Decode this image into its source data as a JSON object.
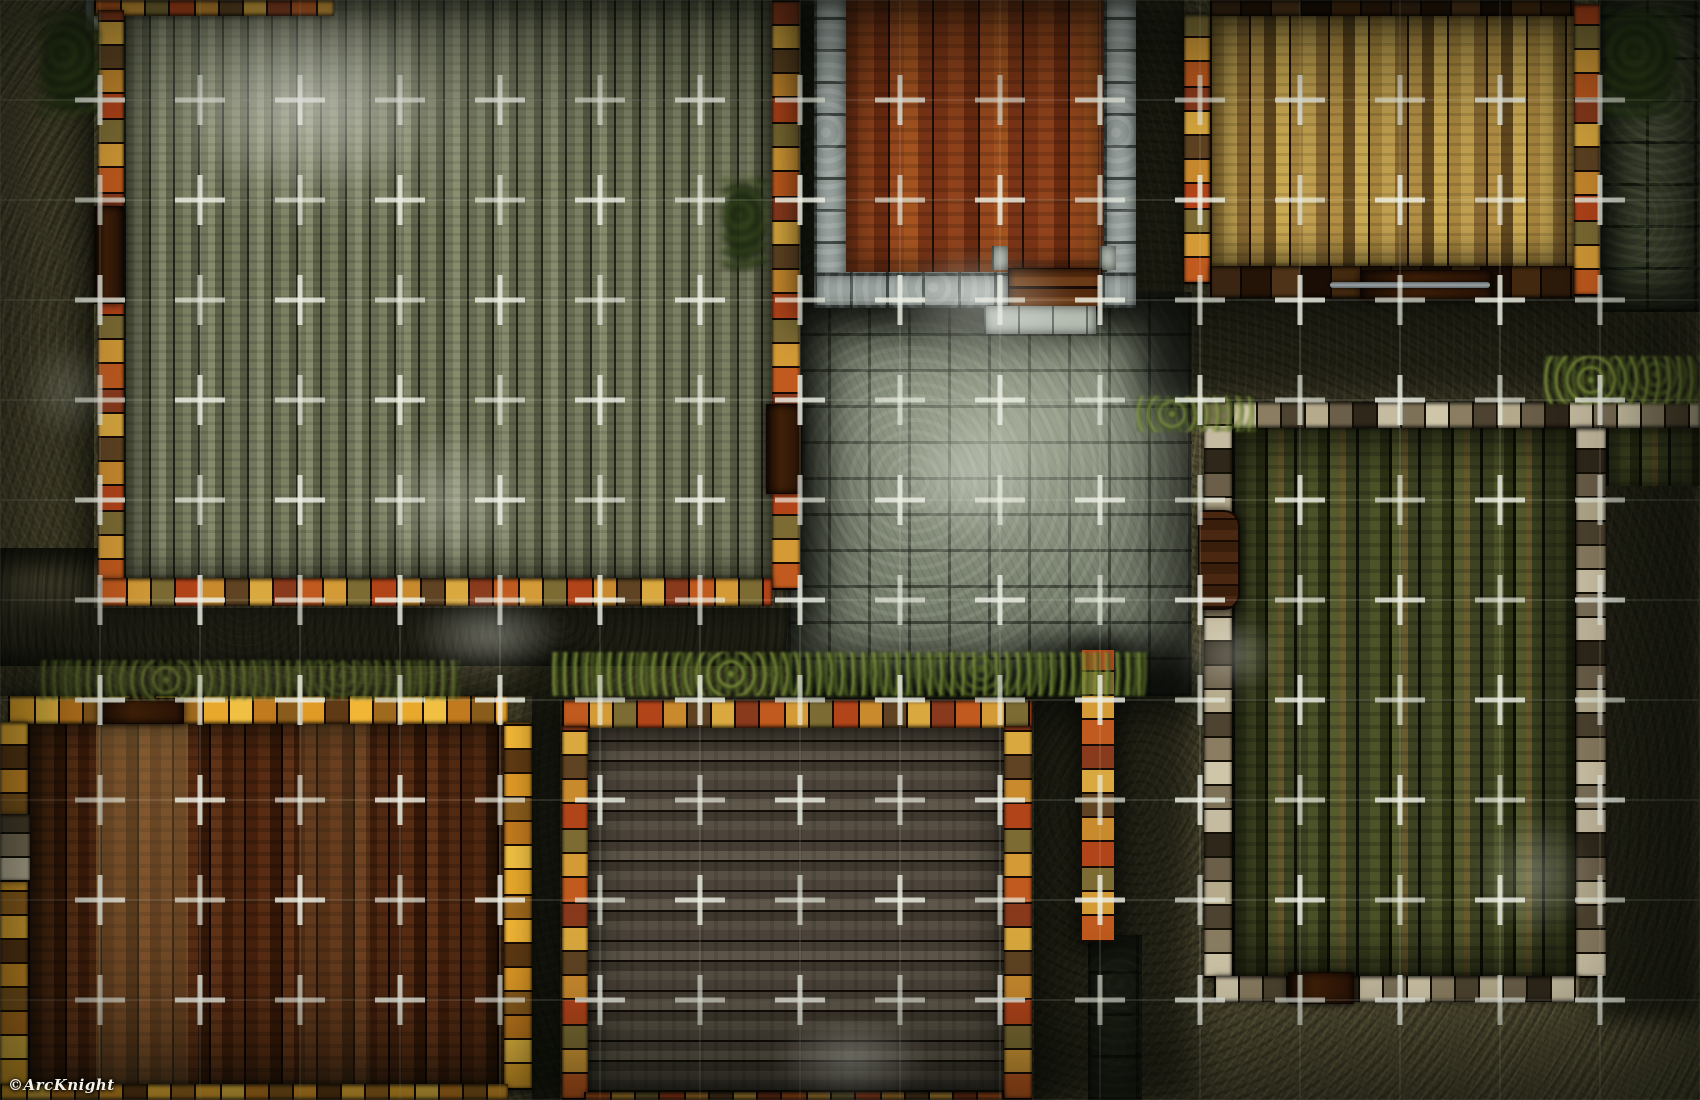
{
  "map": {
    "title": "Town buildings tabletop battle map",
    "watermark": "©ArcKnight",
    "grid": {
      "columns": 17,
      "rows": 11,
      "cell_px": 100,
      "cross_color": "#edefe4",
      "cross_opacity": 0.82,
      "cross_arm_px": 25,
      "cross_stroke_px": 5,
      "line_color": "#cfd4c6",
      "line_opacity": 0.14
    },
    "palette": {
      "grass": "#4b452f",
      "dirt_path": "#57503a",
      "cobblestone": "#79816f",
      "cobblestone_light": "#b9c0ae",
      "stone_wall": "#97a09c",
      "mossy_stone": "#454a36",
      "plank_weathered_green": "#6f7257",
      "plank_red_wood": "#84391a",
      "plank_tan": "#a18040",
      "plank_dark_green": "#3c411f",
      "plank_dark_brown": "#45210e",
      "plank_grey_brown": "#4a423a",
      "border_orange": "#c05a1e",
      "border_gold": "#d9a83e",
      "border_yellow": "#e8a82b",
      "shadow": "#050704"
    },
    "buildings": [
      {
        "id": "top-left-hall",
        "floor": "weathered green-grey vertical planks",
        "border": "mixed orange and gold planks",
        "doors": [
          "west wall",
          "east wall"
        ]
      },
      {
        "id": "stone-house",
        "floor": "red-brown vertical planks",
        "border": "grey stone blocks",
        "doors": [
          "south wall"
        ]
      },
      {
        "id": "top-right-house",
        "floor": "tan golden vertical planks",
        "border": "dark brown planks",
        "doors": [
          "south wall"
        ]
      },
      {
        "id": "right-warehouse",
        "floor": "dark green vertical planks",
        "border": "pale weathered planks",
        "doors": [
          "west wall",
          "south wall"
        ]
      },
      {
        "id": "bottom-left-house",
        "floor": "dark red-brown vertical planks",
        "border": "bright yellow-orange planks",
        "doors": [
          "north wall"
        ]
      },
      {
        "id": "bottom-middle-house",
        "floor": "grey-brown horizontal planks",
        "border": "orange-red planks",
        "doors": []
      }
    ],
    "terrain": [
      "grass",
      "dirt path",
      "cobblestone plaza",
      "mossy stone pavement"
    ]
  }
}
